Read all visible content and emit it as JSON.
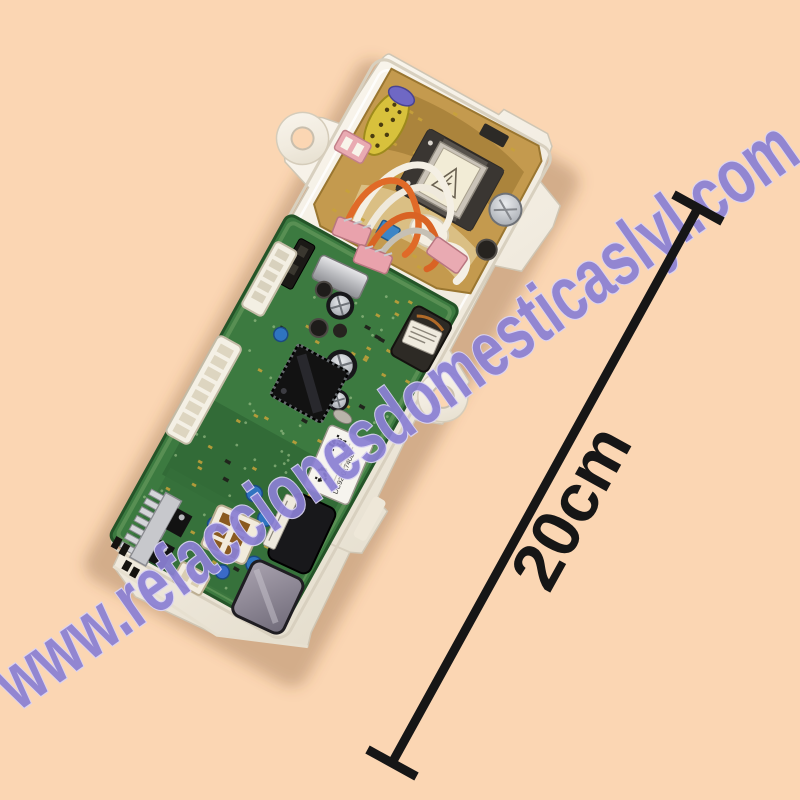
{
  "photo": {
    "description": "Washing machine electronic control board (green PCB with power-supply section) mounted in a white plastic housing, photographed tilted on a peach background"
  },
  "watermark": {
    "text": "www.refaccionesdomesticaslyl.com",
    "color": "#8b80d4",
    "outline": "#d9d3f4"
  },
  "measurement": {
    "label": "20cm",
    "color": "#161616"
  },
  "pcb": {
    "part_label": "DC92-01740B"
  },
  "colors": {
    "background": "#fbd6b3",
    "housing": "#f3ede1",
    "pcb_green": "#3c7a40",
    "power_board_tan": "#c49a4e"
  }
}
